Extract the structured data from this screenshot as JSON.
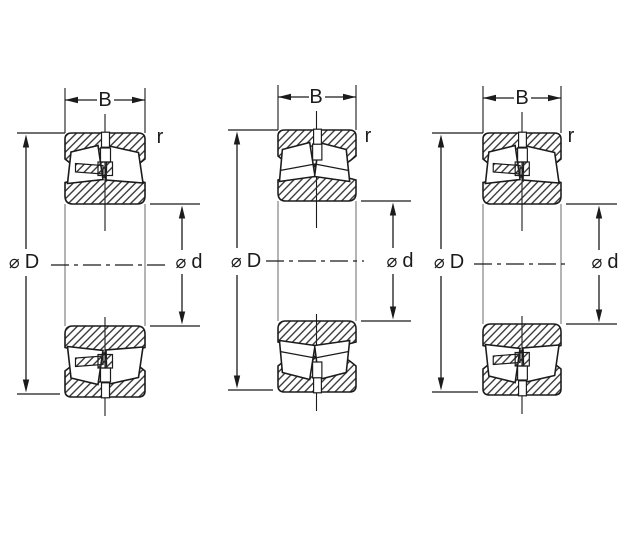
{
  "page": {
    "background": "#ffffff"
  },
  "colors": {
    "line": "#1b1b1b",
    "hatch": "#2b2b2b",
    "silhouette_line": "#a8a8a8"
  },
  "figures": [
    {
      "name": "bearing-cross-section-1",
      "labels": {
        "width": "B",
        "corner_radius": "r",
        "outer_diameter": {
          "symbol": "⌀",
          "letter": "D"
        },
        "bore_diameter": {
          "symbol": "⌀",
          "letter": "d"
        }
      }
    },
    {
      "name": "bearing-cross-section-2",
      "labels": {
        "width": "B",
        "corner_radius": "r",
        "outer_diameter": {
          "symbol": "⌀",
          "letter": "D"
        },
        "bore_diameter": {
          "symbol": "⌀",
          "letter": "d"
        }
      }
    },
    {
      "name": "bearing-cross-section-3",
      "labels": {
        "width": "B",
        "corner_radius": "r",
        "outer_diameter": {
          "symbol": "⌀",
          "letter": "D"
        },
        "bore_diameter": {
          "symbol": "⌀",
          "letter": "d"
        }
      }
    }
  ]
}
